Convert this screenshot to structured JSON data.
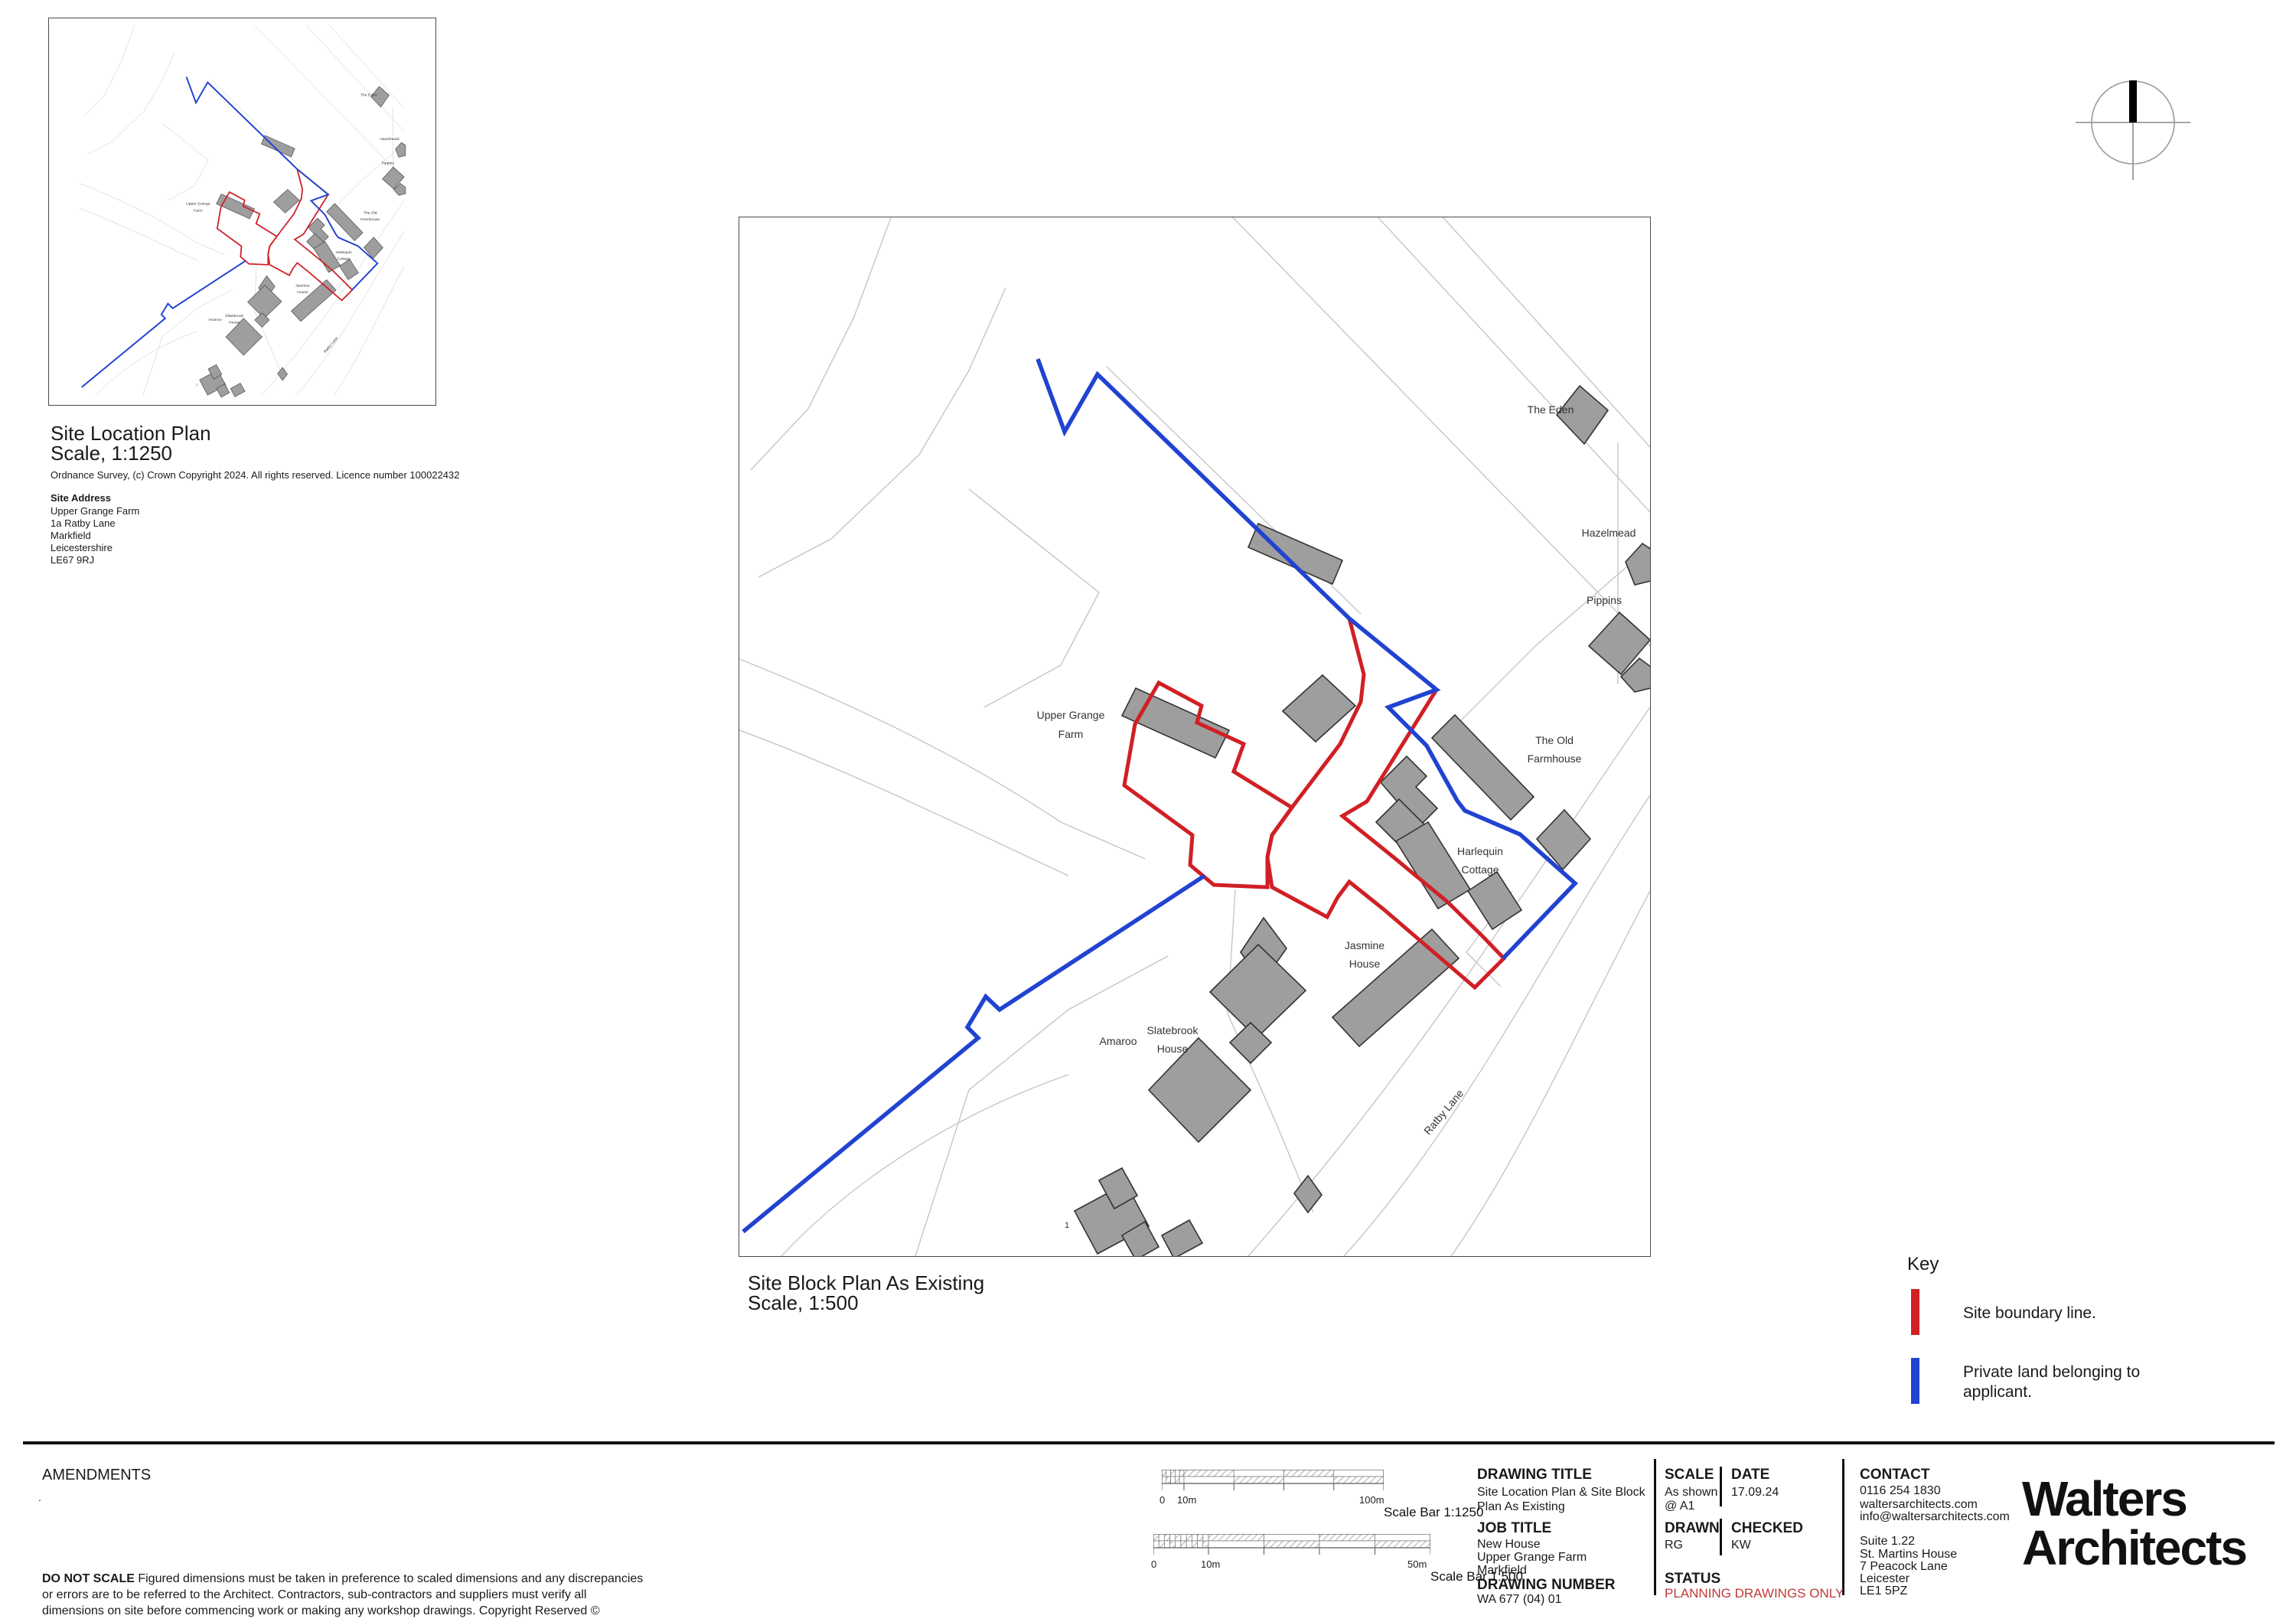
{
  "colors": {
    "boundary_red": "#d02025",
    "private_blue": "#2143d1",
    "status_red": "#bf3a36",
    "building_gray": "#9e9e9e",
    "building_stroke": "#333333",
    "parcel_gray": "#c6c6c6"
  },
  "location_plan": {
    "title": "Site Location Plan",
    "scale": "Scale, 1:1250",
    "copyright": "Ordnance Survey, (c) Crown Copyright 2024. All rights reserved. Licence number 100022432",
    "site_address_heading": "Site Address",
    "site_address": [
      "Upper Grange Farm",
      "1a Ratby Lane",
      "Markfield",
      "Leicestershire",
      "LE67 9RJ"
    ]
  },
  "block_plan": {
    "title": "Site Block Plan As Existing",
    "scale": "Scale, 1:500",
    "map_labels": {
      "the_eden": "The Eden",
      "hazelmead": "Hazelmead",
      "pippins": "Pippins",
      "the_old_farmhouse": [
        "The Old",
        "Farmhouse"
      ],
      "upper_grange_farm": [
        "Upper Grange",
        "Farm"
      ],
      "harlequin_cottage": [
        "Harlequin",
        "Cottage"
      ],
      "slatebrook_house": [
        "Slatebrook",
        "House"
      ],
      "jasmine_house": [
        "Jasmine",
        "House"
      ],
      "amaroo": "Amaroo",
      "ratby_lane": "Ratby Lane",
      "plot_number": "1"
    }
  },
  "key": {
    "title": "Key",
    "items": [
      {
        "label": "Site boundary line."
      },
      {
        "label_line1": "Private land belonging to",
        "label_line2": "applicant."
      }
    ]
  },
  "amendments": {
    "title": "AMENDMENTS",
    "note": "."
  },
  "disclaimer": {
    "bold": "DO NOT SCALE",
    "text": "Figured dimensions must be taken in preference to scaled dimensions and any discrepancies or errors are to be referred to the Architect.  Contractors, sub-contractors and suppliers must verify all dimensions on site before commencing work or making any workshop drawings. Copyright Reserved ©"
  },
  "scale_bars": [
    {
      "caption": "Scale Bar 1:1250",
      "labels": [
        "0",
        "10m",
        "100m"
      ]
    },
    {
      "caption": "Scale Bar 1:500",
      "labels": [
        "0",
        "10m",
        "50m"
      ]
    }
  ],
  "title_block": {
    "drawing_title": {
      "heading": "DRAWING TITLE",
      "line1": "Site Location Plan & Site Block",
      "line2": "Plan As Existing"
    },
    "job_title": {
      "heading": "JOB TITLE",
      "line1": "New House",
      "line2": "Upper Grange Farm",
      "line3": "Markfield"
    },
    "drawing_number": {
      "heading": "DRAWING NUMBER",
      "value": "WA 677 (04) 01"
    },
    "scale": {
      "heading": "SCALE",
      "line1": "As shown",
      "line2": "@ A1"
    },
    "date": {
      "heading": "DATE",
      "value": "17.09.24"
    },
    "drawn": {
      "heading": "DRAWN",
      "value": "RG"
    },
    "checked": {
      "heading": "CHECKED",
      "value": "KW"
    },
    "status": {
      "heading": "STATUS",
      "value": "PLANNING DRAWINGS ONLY"
    },
    "contact": {
      "heading": "CONTACT",
      "phone": "0116 254 1830",
      "website": "waltersarchitects.com",
      "email": "info@waltersarchitects.com",
      "address": [
        "Suite 1.22",
        "St. Martins House",
        "7 Peacock Lane",
        "Leicester",
        "LE1 5PZ"
      ]
    }
  },
  "logo": {
    "line1": "Walters",
    "line2": "Architects"
  }
}
